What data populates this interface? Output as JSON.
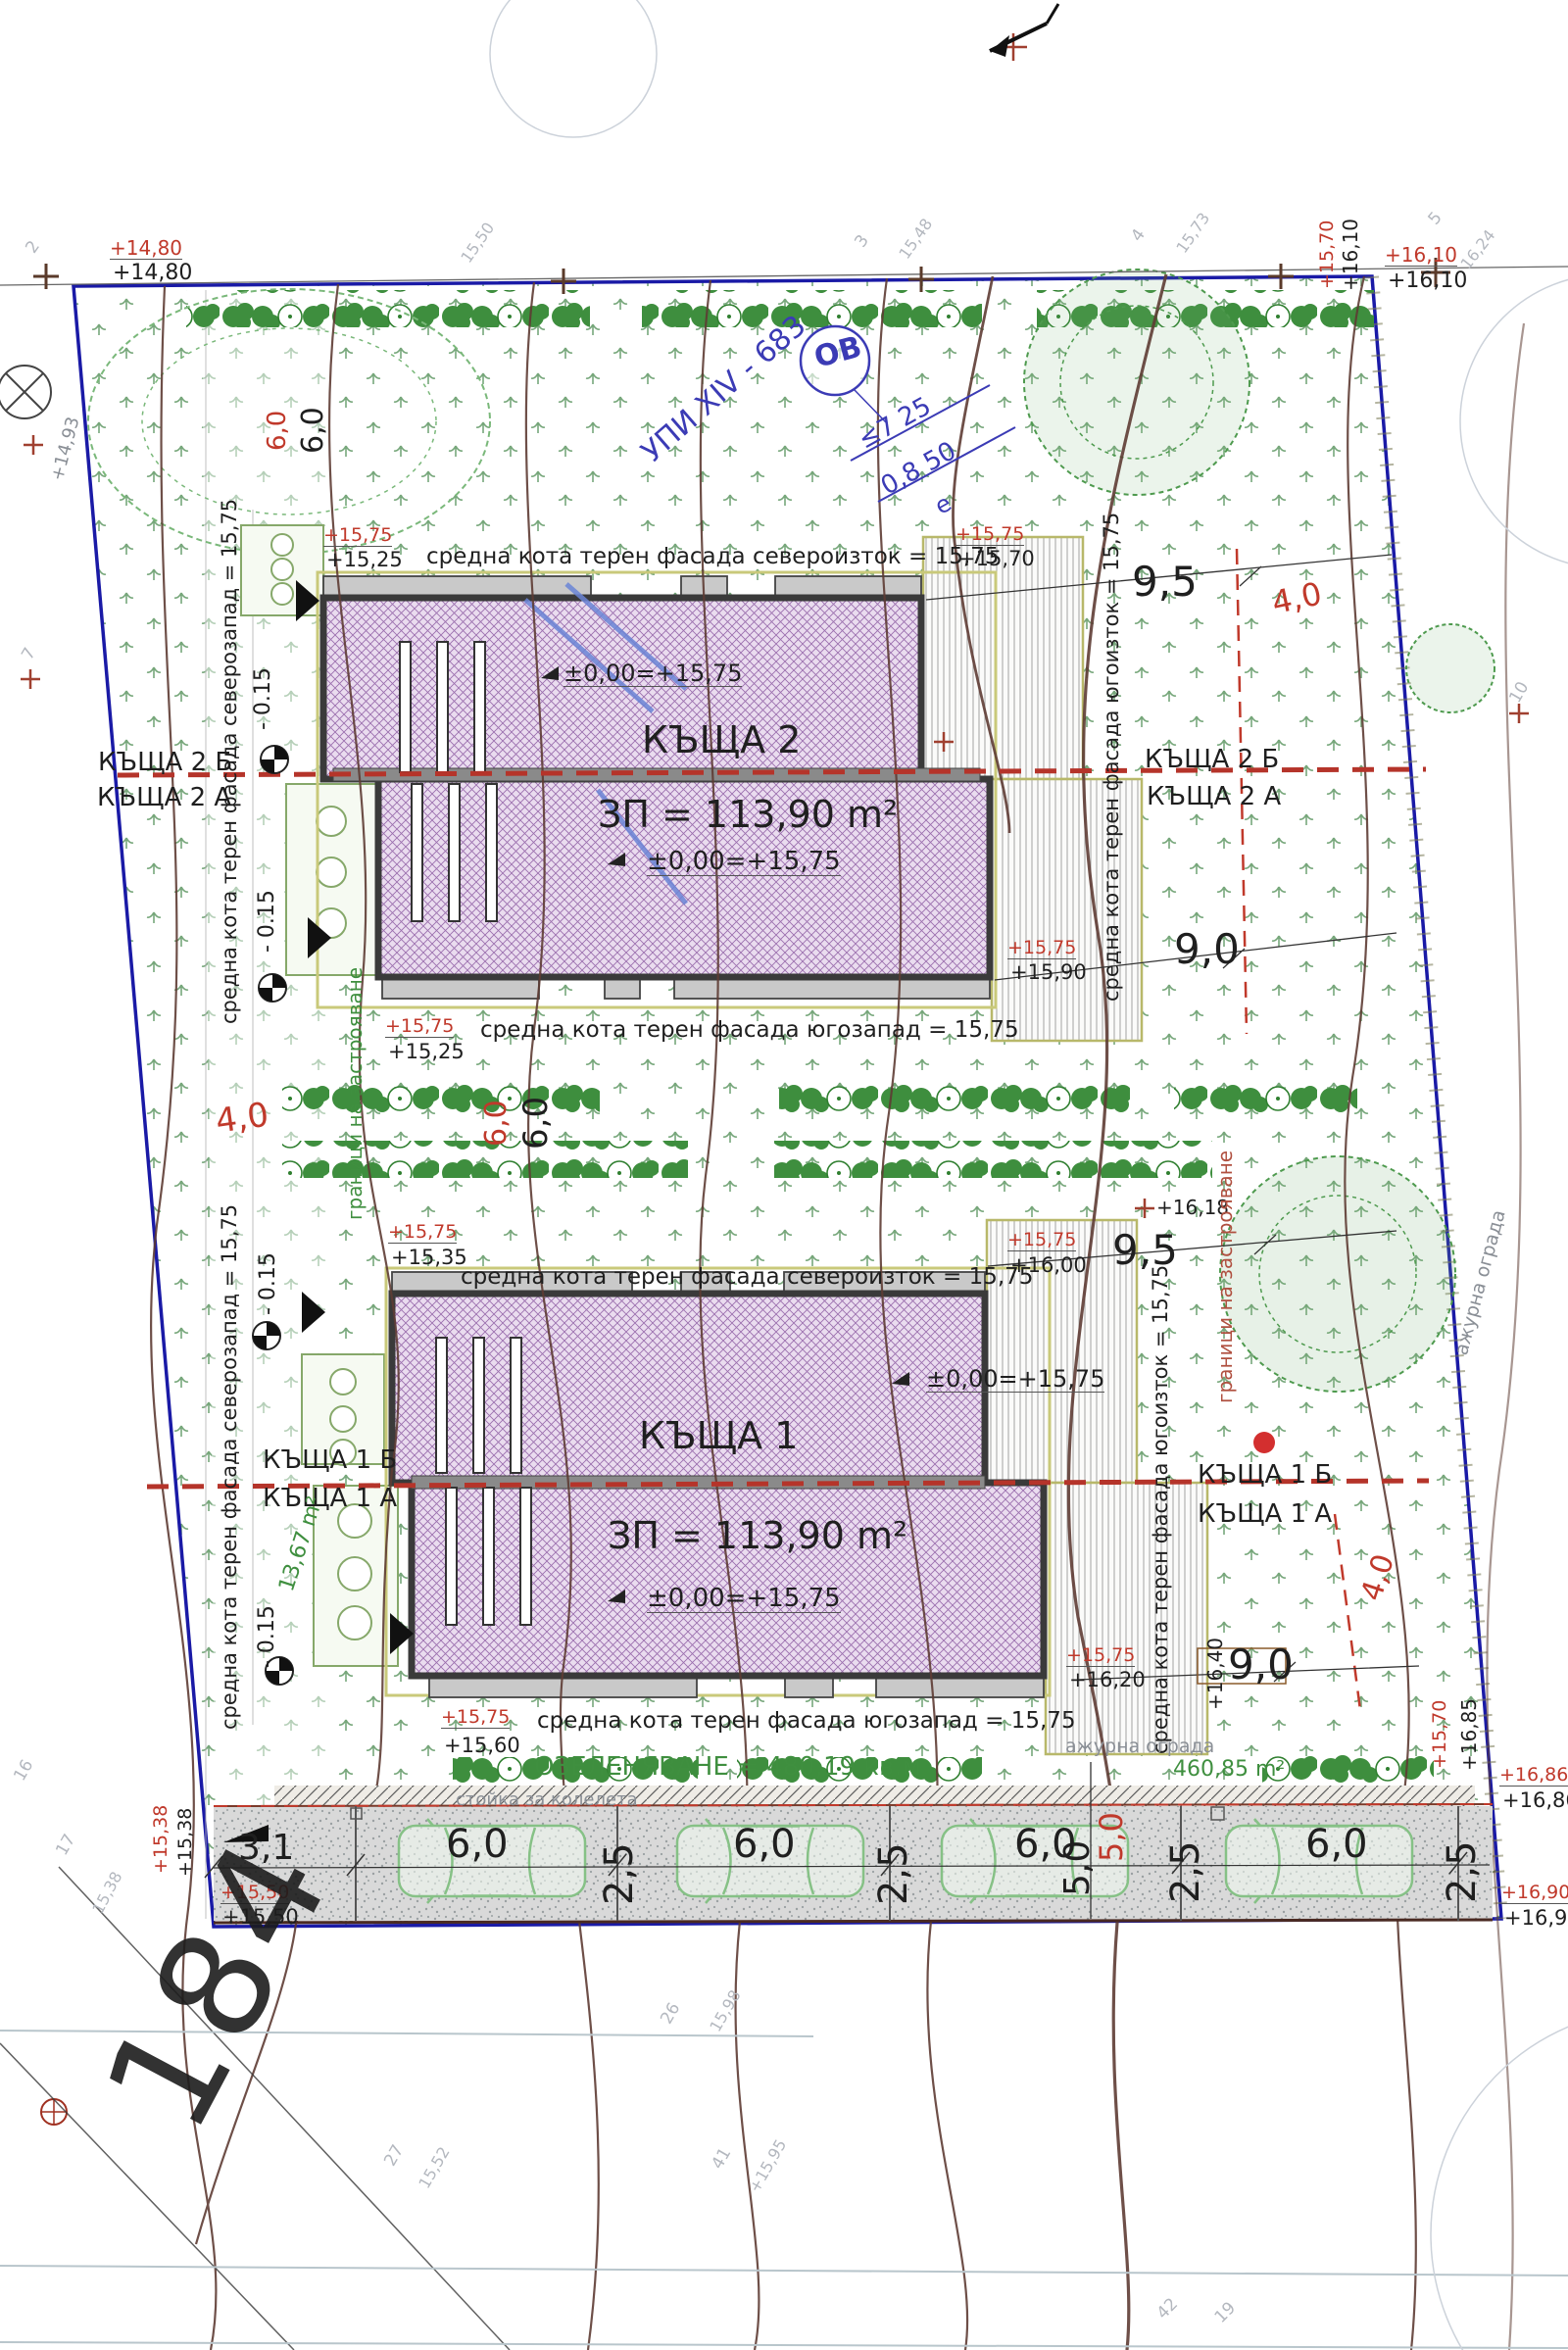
{
  "colors": {
    "boundary": "#1a1aa6",
    "contour": "#5d3b35",
    "red": "#c0392b",
    "green": "#3f8f3f",
    "hatch_purple": "#9b6fae",
    "note_blue": "#3b3bb5"
  },
  "labels": {
    "upi": "УПИ XIV - 683",
    "ov": "ОВ",
    "frac1": "≤7  25",
    "frac2": "0,8  50",
    "frac_e": "е",
    "zero": "±0,00=+15,75",
    "fac_ne": "средна кота терен фасада североизток = 15,75",
    "fac_sw": "средна кота терен фасада югозапад = 15,75",
    "fac_nw": "средна кота терен фасада северозапад = 15,75",
    "fac_se": "средна кота терен фасада югоизток = 15,75",
    "h2": {
      "name": "КЪЩА 2",
      "area": "ЗП = 113,90 m²",
      "unit_b": "КЪЩА 2 Б",
      "unit_a": "КЪЩА 2 А"
    },
    "h1": {
      "name": "КЪЩА 1",
      "area": "ЗП = 113,90 m²",
      "unit_b": "КЪЩА 1 Б",
      "unit_a": "КЪЩА 1 А"
    },
    "limits": "граници на застрояване",
    "fence": "ажурна ограда",
    "landscaping": "ОЗЕЛЕНЯВАНЕ = 480,19 кв.м",
    "bike": "стойка за колелета",
    "area_right": "460,85 m²",
    "terrace_area": "13,67 m²",
    "d95": "9,5",
    "d90": "9,0",
    "d40": "4,0",
    "d60": "6,0",
    "d31": "3,1",
    "d25": "2,5",
    "d50": "5,0",
    "offset": "- 0.15",
    "big": "184"
  },
  "elev": {
    "v1480": "+14,80",
    "v1493": "+14,93",
    "v1525": "+15,25",
    "v1535": "+15,35",
    "v1538": "+15,38",
    "v1550": "+15,50",
    "v1560": "+15,60",
    "v1570": "+15,70",
    "v1575": "+15,75",
    "v1590": "+15,90",
    "v1600": "+16,00",
    "v1610": "+16,10",
    "v1618": "+16,18",
    "v1620": "+16,20",
    "v1640": "+16,40",
    "v1685": "+16,85",
    "v1686": "+16,86",
    "v1690": "+16,90"
  },
  "survey": {
    "n2": "2",
    "n3": "3",
    "n4": "4",
    "n5": "5",
    "n7": "7",
    "n10": "10",
    "n16": "16",
    "n17": "17",
    "n19": "19",
    "n26": "26",
    "n27": "27",
    "n41": "41",
    "n42": "42",
    "c1538": "15,38",
    "c1548": "15,48",
    "c1550": "15,50",
    "c1552": "15,52",
    "c1573": "15,73",
    "c1595": "+15,95",
    "c1598": "15,98",
    "c1624": "16,24"
  }
}
